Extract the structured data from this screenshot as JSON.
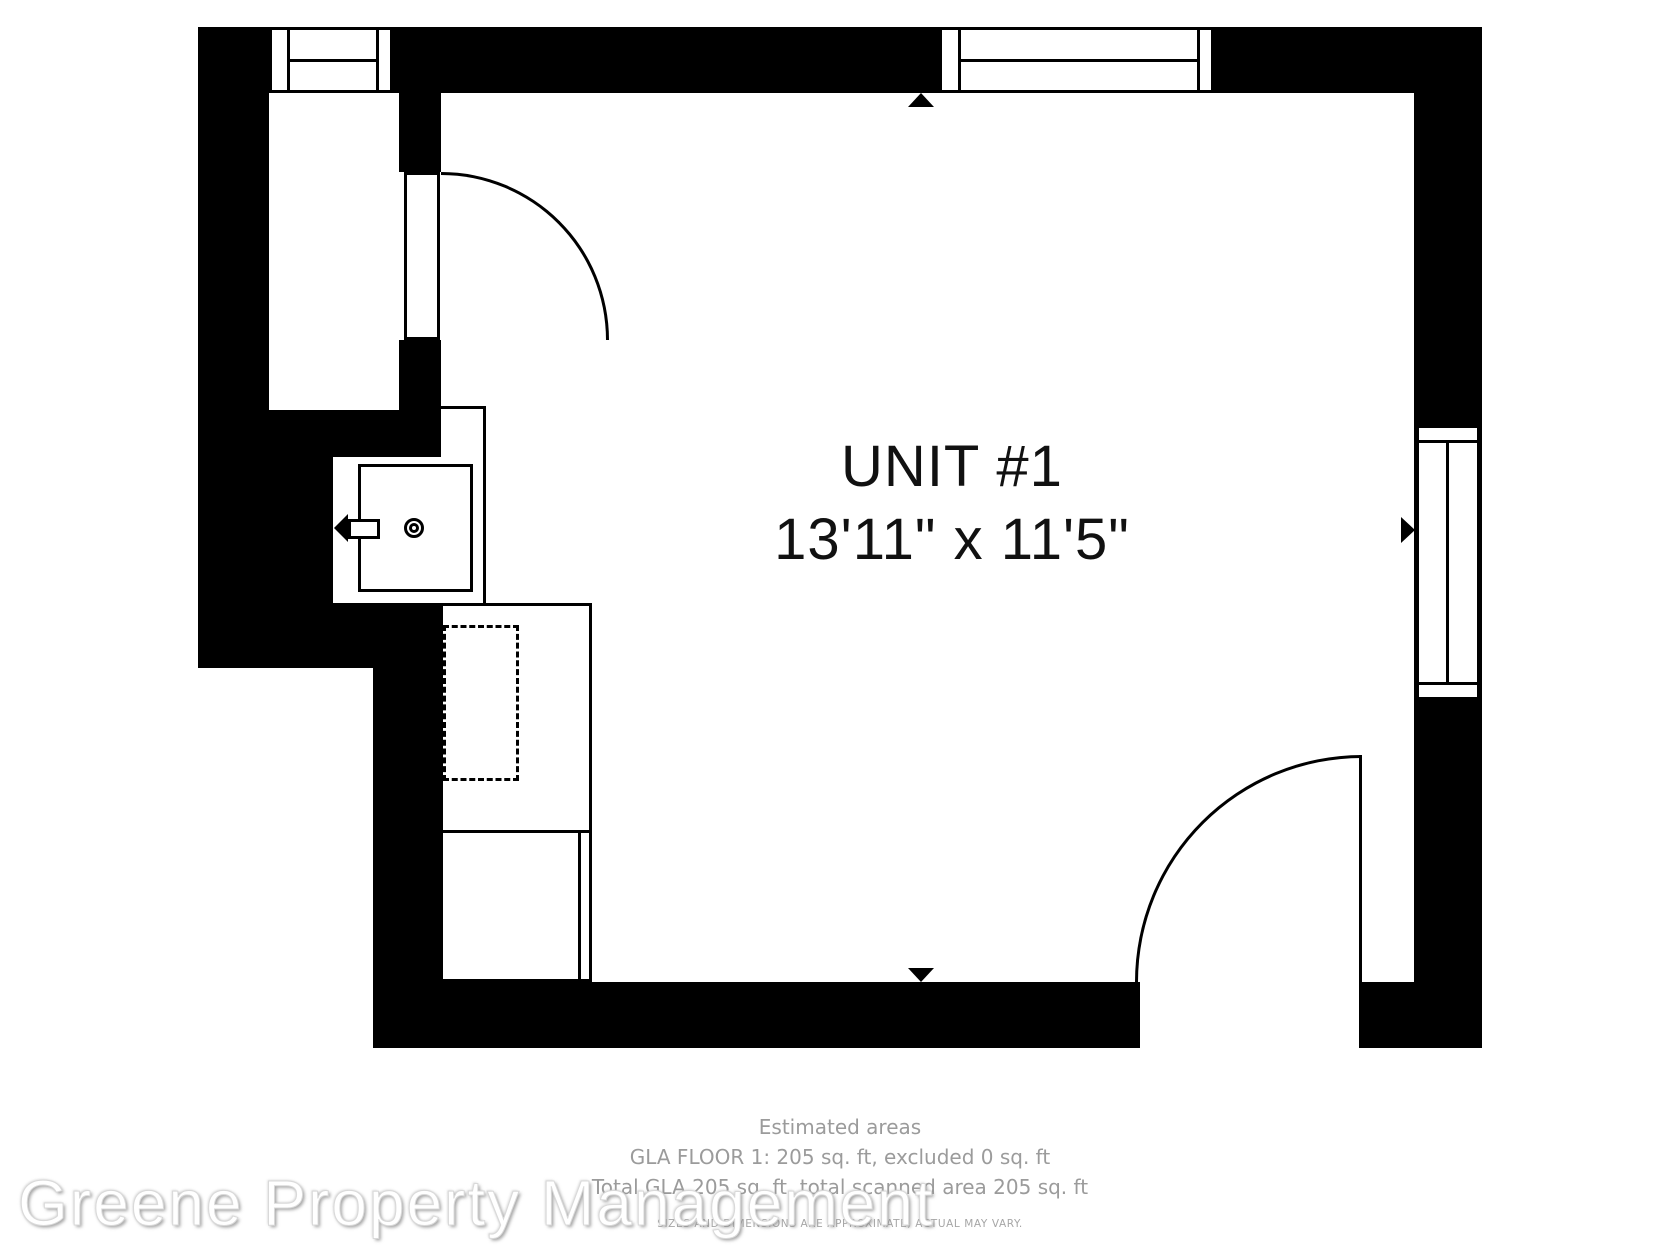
{
  "floor_plan": {
    "title": "UNIT #1",
    "dimensions": "13'11\" x 11'5\"",
    "colors": {
      "wall": "#000000",
      "background": "#ffffff",
      "title_text": "#111111",
      "footer_text": "#9b9b9b",
      "disclaimer_text": "#a6a6a6",
      "watermark_text": "#ffffff"
    },
    "icons": [
      "window-icon-top-left",
      "window-icon-top-right",
      "window-icon-right",
      "door-swing-arc-left",
      "door-swing-arc-bottom",
      "sink-icon",
      "faucet-arrow-icon",
      "dashed-appliance-icon",
      "wall-midpoint-arrow-up",
      "wall-midpoint-arrow-down",
      "wall-midpoint-arrow-right"
    ]
  },
  "footer": {
    "estimated_areas_label": "Estimated areas",
    "gla_floor_line": "GLA FLOOR 1: 205 sq. ft, excluded 0 sq. ft",
    "total_gla_line": "Total GLA 205 sq. ft, total scanned area 205 sq. ft",
    "disclaimer": "SIZES AND DIMENSIONS ARE APPROXIMATE, ACTUAL MAY VARY."
  },
  "watermark": {
    "text": "Greene Property Management"
  }
}
